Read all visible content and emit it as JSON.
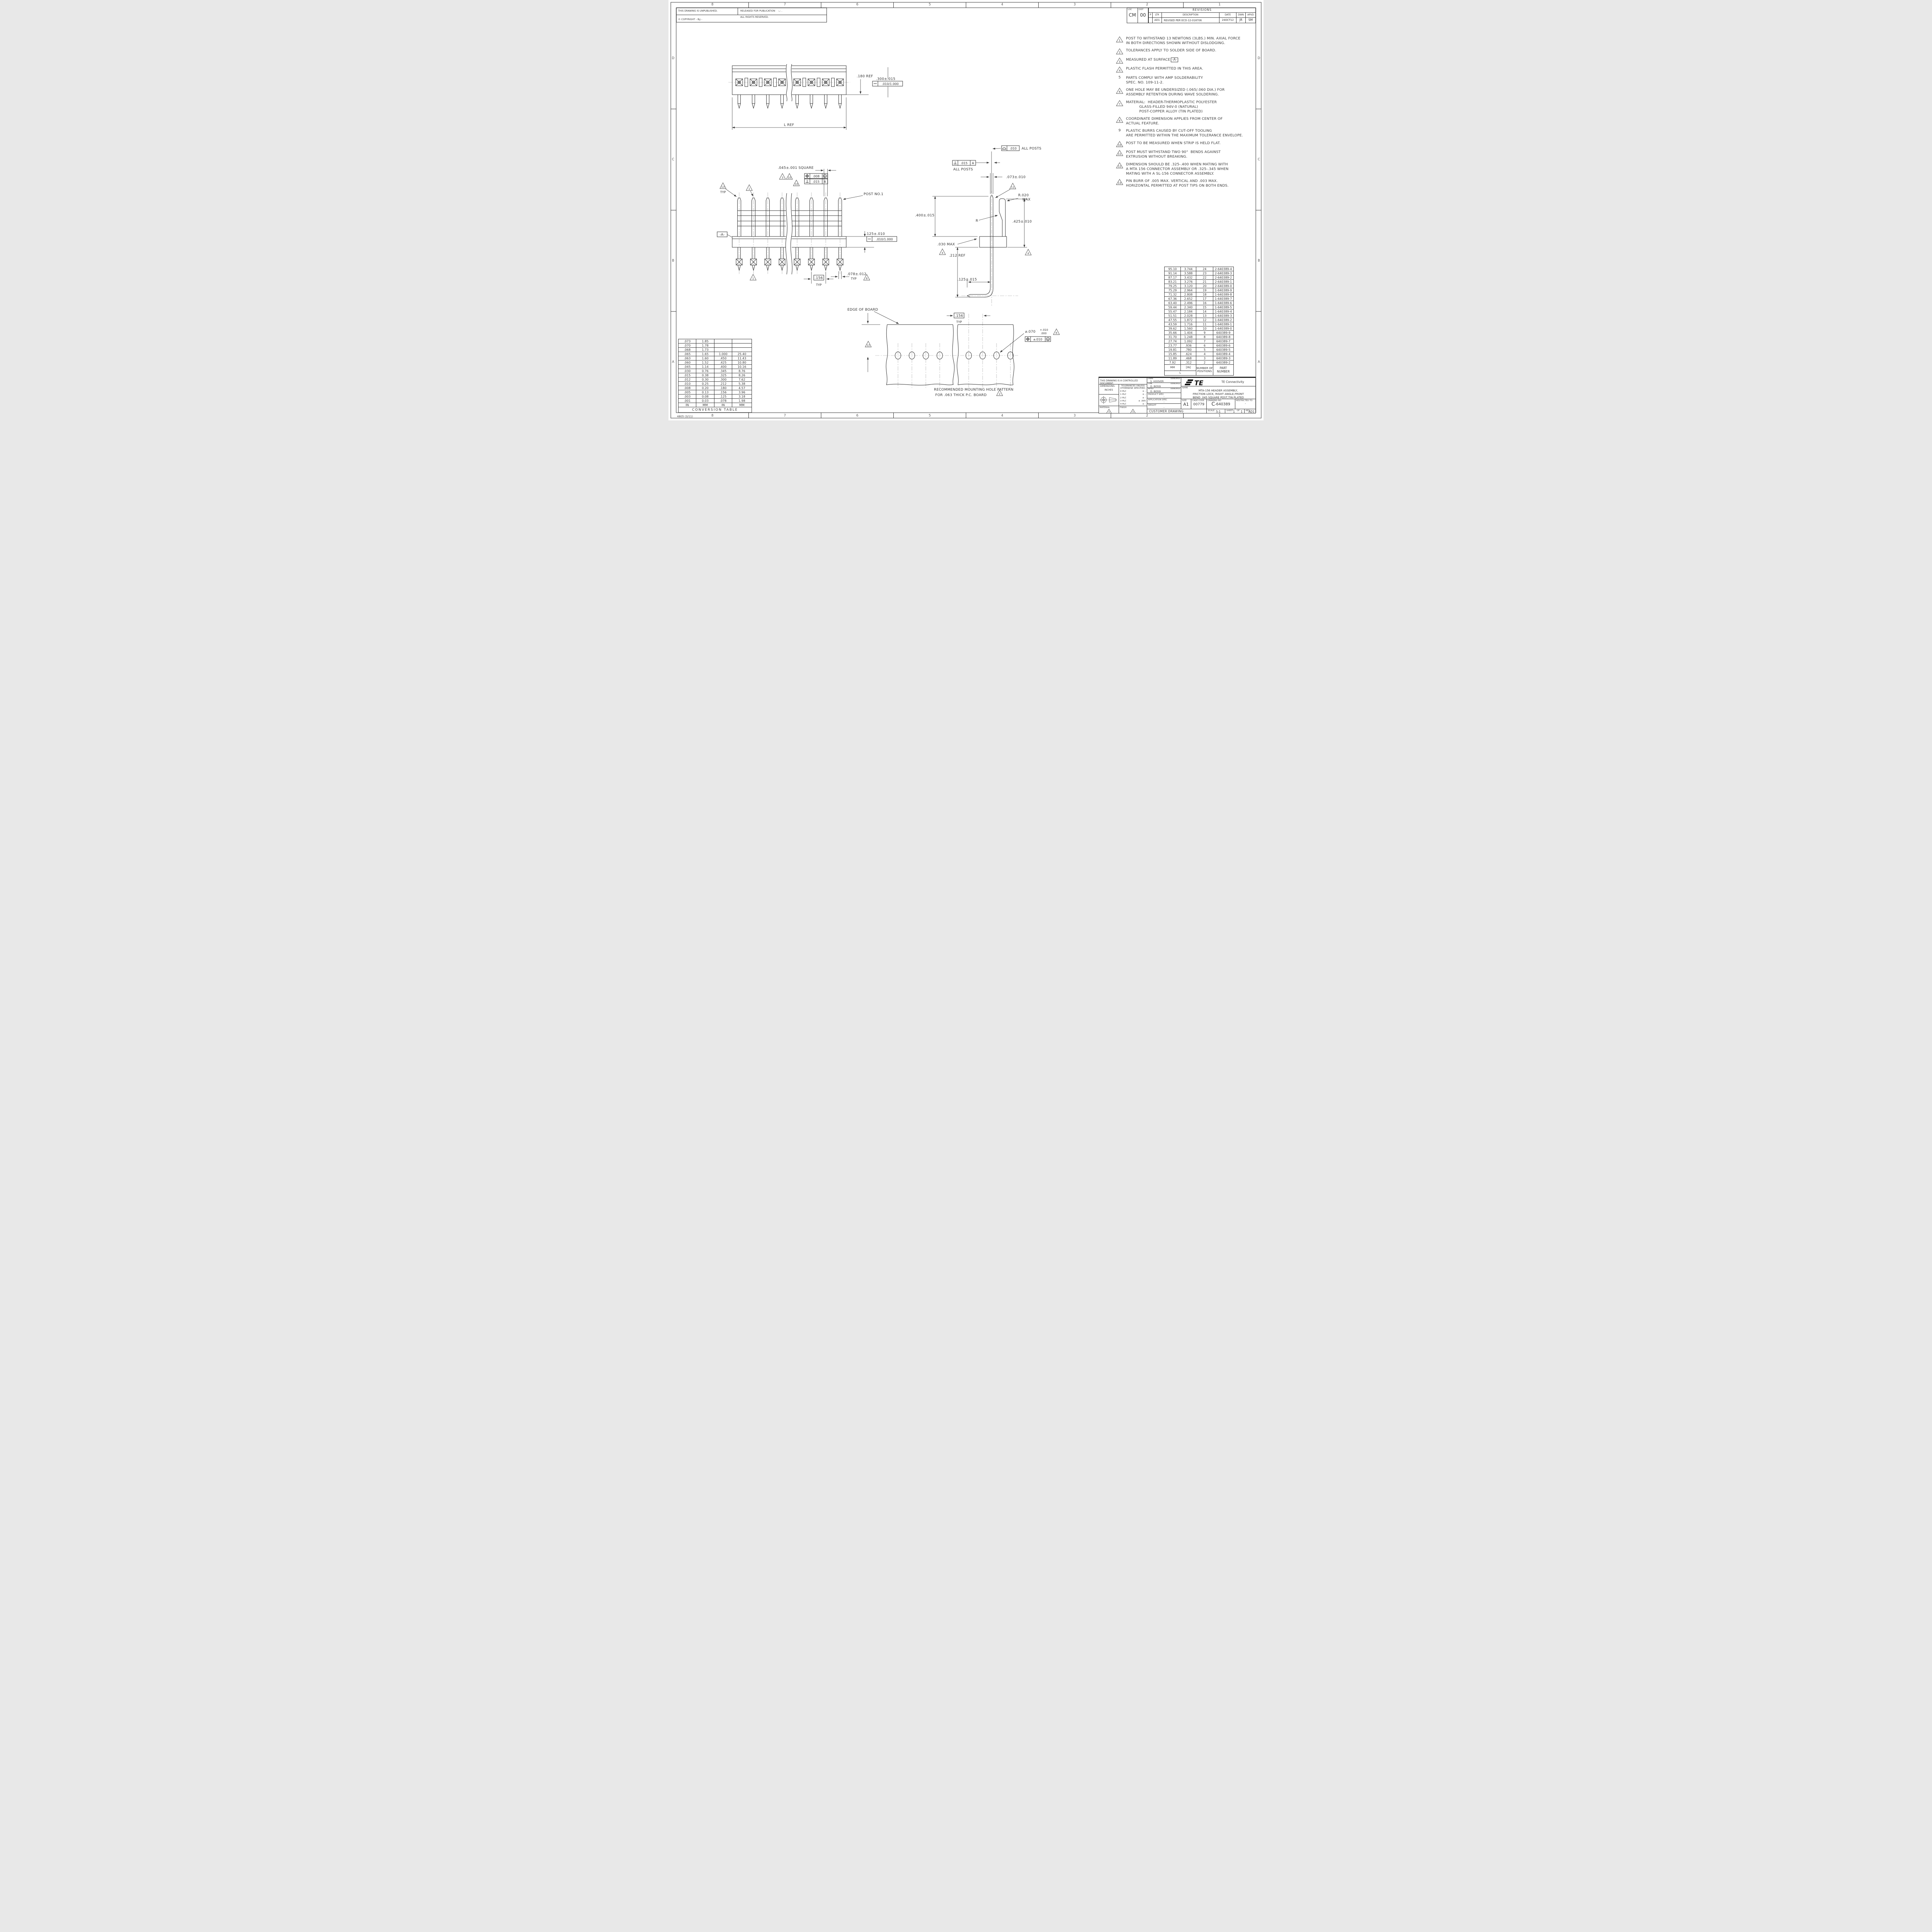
{
  "sheet": {
    "zone_cols": [
      "8",
      "7",
      "6",
      "5",
      "4",
      "3",
      "2",
      "1"
    ],
    "zone_rows": [
      "D",
      "C",
      "B",
      "A"
    ],
    "form_no": "4805 (3/11)"
  },
  "legal": {
    "unpublished": "THIS DRAWING IS UNPUBLISHED.",
    "released": "RELEASED FOR PUBLICATION",
    "released_value": "-,-   .",
    "copyright": "© COPYRIGHT   -      By -",
    "rights": "ALL RIGHTS RESERVED.",
    "loc_label": "LOC",
    "loc_value": "CM",
    "dist_label": "DIST",
    "dist_value": "00"
  },
  "revisions": {
    "title": "REVISIONS",
    "col_p": "P",
    "col_ltr": "LTR",
    "col_desc": "DESCRIPTION",
    "col_date": "DATE",
    "col_dwn": "DWN",
    "col_apvd": "APVD",
    "row": {
      "ltr": "AD1",
      "description": "REVISED PER ECO-12-018706",
      "date": "24OCT12",
      "dwn": "JR",
      "apvd": "SM"
    }
  },
  "notes": [
    {
      "flag": "1",
      "text": "POST TO WITHSTAND 13 NEWTONS (3LBS.) MIN. AXIAL FORCE\nIN BOTH DIRECTIONS SHOWN WITHOUT DISLODGING."
    },
    {
      "flag": "2",
      "text": "TOLERANCES APPLY TO SOLDER SIDE OF BOARD."
    },
    {
      "flag": "3",
      "text": "MEASURED AT SURFACE",
      "datum": "-A-"
    },
    {
      "flag": "4",
      "text": "PLASTIC FLASH PERMITTED IN THIS AREA."
    },
    {
      "flag": "5",
      "text": "PARTS COMPLY WITH AMP SOLDERABILITY\nSPEC. NO. 109-11-2."
    },
    {
      "flag": "6",
      "text": "ONE HOLE MAY BE UNDERSIZED (.065/.060 DIA.) FOR\nASSEMBLY RETENTION DURING WAVE SOLDERING."
    },
    {
      "flag": "7",
      "text": "MATERIAL:  HEADER-THERMOPLASTIC POLYESTER\n           GLASS-FILLED 94V-0 (NATURAL)\n           POST-COPPER ALLOY (TIN PLATED)"
    },
    {
      "flag": "8",
      "text": "COORDINATE DIMENSION APPLIES FROM CENTER OF\nACTUAL FEATURE."
    },
    {
      "flag": "9",
      "text": "PLASTIC BURRS CAUSED BY CUT-OFF TOOLING\nARE PERMITTED WITHIN THE MAXIMUM TOLERANCE ENVELOPE."
    },
    {
      "flag": "10",
      "text": "POST TO BE MEASURED WHEN STRIP IS HELD FLAT."
    },
    {
      "flag": "11",
      "text": "POST MUST WITHSTAND TWO 90°  BENDS AGAINST\nEXTRUSION WITHOUT BREAKING."
    },
    {
      "flag": "12",
      "text": "DIMENSION SHOULD BE .325-.400 WHEN MATING WITH\nA MTA 156 CONNECTOR ASSEMBLY OR .325-.345 WHEN\nMATING WITH A SL-156 CONNECTOR ASSEMBLY."
    },
    {
      "flag": "13",
      "text": "PIN BURR OF .005 MAX. VERTICAL AND .003 MAX.\nHORIZONTAL PERMITTED AT POST TIPS ON BOTH ENDS."
    }
  ],
  "callouts": {
    "top": {
      "dim180": ".180 REF",
      "dim300": ".300±.015",
      "fcf_straight": ".010/1.000",
      "lref": "L REF"
    },
    "front": {
      "square": ".045±.001 SQUARE",
      "pos_val": ".008",
      "pos_mod": "M",
      "perp_val": ".015",
      "perp_datum": "A",
      "typ": "TYP",
      "post1": "POST NO.1",
      "datum_a": "-A-",
      "dim125": ".125±.010",
      "fcf_straight": ".010/1.000",
      "p156": ".156",
      "typ2": "TYP",
      "dim078": ".078±.012",
      "typ3": "TYP"
    },
    "side": {
      "profile_val": ".010",
      "all_posts": "ALL POSTS",
      "perp_val": ".015",
      "perp_datum": "A",
      "all_posts2": "ALL POSTS",
      "dim073": ".073±.010",
      "r020": "R.020",
      "max": "MAX",
      "r": "R",
      "dim400": ".400±.015",
      "dim425": ".425±.010",
      "dim030": ".030 MAX",
      "dim212": ".212 REF",
      "dim125": ".125±.015"
    },
    "board": {
      "edge": "EDGE OF BOARD",
      "p156": ".156",
      "typ": "TYP",
      "dia": "⌀.070",
      "dia_plus": "+.010",
      "dia_minus": ".000",
      "fcf_dia": "⌀.010",
      "fcf_mod": "M",
      "cap1": "RECOMMENDED MOUNTING HOLE PATTERN",
      "cap2": "FOR .063 THICK P.C. BOARD"
    },
    "flags": {
      "f1": "1",
      "f2": "2",
      "f3": "3",
      "f4": "4",
      "f6": "6",
      "f8": "8",
      "f10": "10",
      "f11": "11",
      "f12": "12",
      "f13": "13"
    }
  },
  "part_table": {
    "rows": [
      [
        "95.10",
        "3.744",
        "24",
        "2-640389-4"
      ],
      [
        "91.14",
        "3.588",
        "23",
        "2-640389-3"
      ],
      [
        "87.17",
        "3.432",
        "22",
        "2-640389-2"
      ],
      [
        "83.21",
        "3.276",
        "21",
        "2-640389-1"
      ],
      [
        "79.25",
        "3.120",
        "20",
        "2-640389-0"
      ],
      [
        "75.29",
        "2.964",
        "19",
        "1-640389-9"
      ],
      [
        "71.32",
        "2.808",
        "18",
        "1-640389-8"
      ],
      [
        "67.36",
        "2.652",
        "17",
        "1-640389-7"
      ],
      [
        "63.40",
        "2.496",
        "16",
        "1-640389-6"
      ],
      [
        "59.44",
        "2.340",
        "15",
        "1-640389-5"
      ],
      [
        "55.47",
        "2.184",
        "14",
        "1-640389-4"
      ],
      [
        "51.51",
        "2.028",
        "13",
        "1-640389-3"
      ],
      [
        "47.55",
        "1.872",
        "12",
        "1-640389-2"
      ],
      [
        "43.59",
        "1.716",
        "11",
        "1-640389-1"
      ],
      [
        "39.62",
        "1.560",
        "10",
        "1-640389-0"
      ],
      [
        "35.66",
        "1.404",
        "9",
        "640389-9"
      ],
      [
        "31.70",
        "1.248",
        "8",
        "640389-8"
      ],
      [
        "27.74",
        "1.092",
        "7",
        "640389-7"
      ],
      [
        "23.77",
        ".936",
        "6",
        "640389-6"
      ],
      [
        "19.81",
        ".780",
        "5",
        "640389-5"
      ],
      [
        "15.85",
        ".624",
        "4",
        "640389-4"
      ],
      [
        "11.89",
        ".468",
        "3",
        "640389-3"
      ],
      [
        "7.92",
        ".312",
        "2",
        "640389-2"
      ]
    ],
    "header": {
      "mm": "MM",
      "in": "[IN]",
      "positions": "NUMBER OF\nPOSITIONS",
      "part": "PART NUMBER",
      "l": "L"
    }
  },
  "conversion_table": {
    "rows": [
      [
        ".073",
        "1.85",
        "",
        ""
      ],
      [
        ".070",
        "1.78",
        "",
        ""
      ],
      [
        ".068",
        "1.73",
        "",
        ""
      ],
      [
        ".065",
        "1.65",
        "1.000",
        "25.40"
      ],
      [
        ".063",
        "1.60",
        ".450",
        "11.43"
      ],
      [
        ".060",
        "1.52",
        ".425",
        "10.80"
      ],
      [
        ".045",
        "1.14",
        ".400",
        "10.16"
      ],
      [
        ".030",
        "0.76",
        ".345",
        "8.76"
      ],
      [
        ".015",
        "0.38",
        ".325",
        "8.26"
      ],
      [
        ".012",
        "0.30",
        ".300",
        "7.62"
      ],
      [
        ".010",
        "0.25",
        ".212",
        "5.38"
      ],
      [
        ".008",
        "0.20",
        ".180",
        "4.57"
      ],
      [
        ".005",
        "0.13",
        ".156",
        "3.96"
      ],
      [
        ".003",
        "0.08",
        ".125",
        "3.18"
      ],
      [
        ".001",
        "0.03",
        ".078",
        "1.98"
      ]
    ],
    "footer": [
      "IN",
      "MM",
      "IN",
      "MM"
    ],
    "title": "CONVERSION TABLE"
  },
  "title_block": {
    "controlled": "THIS DRAWING IS A CONTROLLED DOCUMENT.",
    "dwn_label": "DWN",
    "dwn_name": "S. HOOVER",
    "dwn_date": "05NOV02",
    "chk_label": "CHK",
    "chk_name": "D. BOSSI",
    "chk_date": "05NOV02",
    "apvd_label": "APVD",
    "apvd_name": "D. BOSSI",
    "apvd_date": "05NOV02",
    "dimensions_label": "DIMENSIONS:",
    "units": "INCHES",
    "tol_title": "TOLERANCES UNLESS\nOTHERWISE SPECIFIED:",
    "tol_rows": [
      [
        "0 PLC",
        "± -"
      ],
      [
        "1 PLC",
        "± -"
      ],
      [
        "2 PLC",
        "± -"
      ],
      [
        "3 PLC",
        "± .005"
      ],
      [
        "4 PLC",
        "± -"
      ],
      [
        "ANGLES",
        "± -"
      ]
    ],
    "material_label": "MATERIAL",
    "finish_label": "FINISH",
    "flag7": "7",
    "product_spec_label": "PRODUCT SPEC",
    "product_spec_value": "-",
    "application_spec_label": "APPLICATION SPEC",
    "application_spec_value": "-",
    "weight_label": "WEIGHT",
    "weight_value": "-",
    "logo_text": "TE",
    "company": "TE Connectivity",
    "name_label": "NAME",
    "name_value": "MTA-156 HEADER ASSEMBLY,\nFRICTION LOCK, RIGHT ANGLE,FRONT\nBEND .045 SQUARE POST,TIN PLATED",
    "size_label": "SIZE",
    "size_value": "A1",
    "cage_label": "CAGE CODE",
    "cage_value": "00779",
    "dwg_label": "DRAWING NO",
    "dwg_prefix": "C",
    "dwg_number": "640389",
    "restricted_label": "RESTRICTED TO",
    "restricted_value": "-",
    "customer": "CUSTOMER DRAWING",
    "scale_label": "SCALE",
    "scale_value": "5:1",
    "sheet_label": "SHEET",
    "of_label": "OF",
    "sheet_value": "1",
    "of_value": "1",
    "rev_label": "REV",
    "rev_value": "AD1"
  }
}
